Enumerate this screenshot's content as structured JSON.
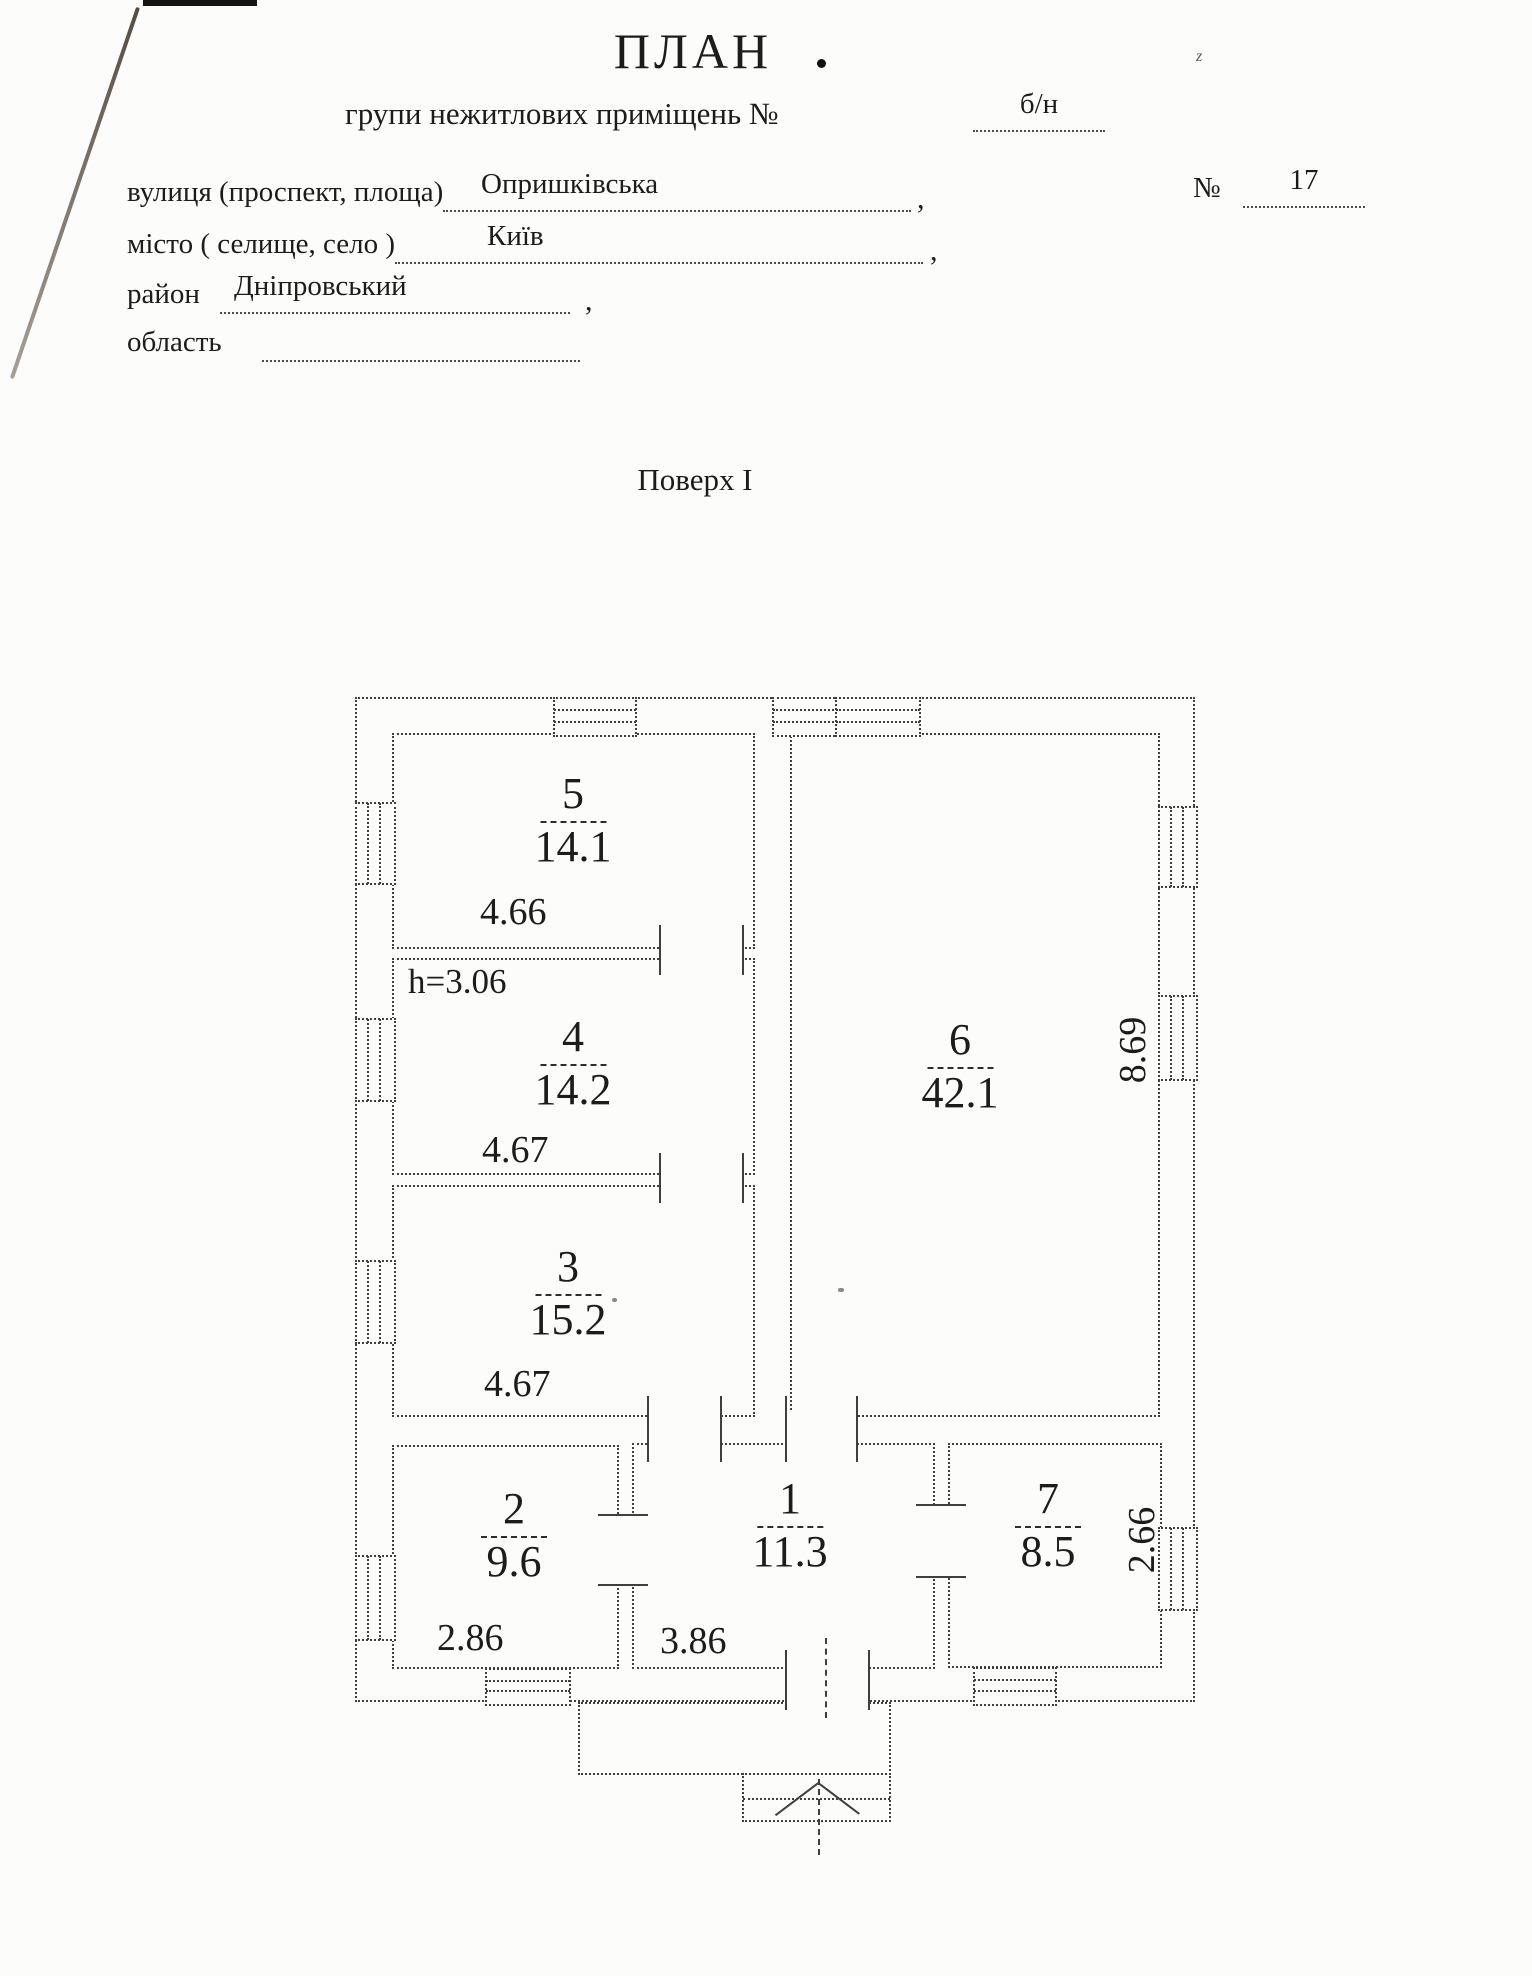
{
  "header": {
    "title": "ПЛАН",
    "subtitle_label": "групи нежитлових приміщень №",
    "subtitle_value": "б/н",
    "street_label": "вулиця (проспект, площа)",
    "street_value": "Опришківська",
    "number_label": "№",
    "number_value": "17",
    "city_label": "місто ( селище, село )",
    "city_value": "Київ",
    "district_label": "район",
    "district_value": "Дніпровський",
    "region_label": "область",
    "region_value": "",
    "comma": ",",
    "floor_title": "Поверх I"
  },
  "plan": {
    "rooms": {
      "r1": {
        "num": "1",
        "area": "11.3",
        "dim": "3.86"
      },
      "r2": {
        "num": "2",
        "area": "9.6",
        "dim": "2.86"
      },
      "r3": {
        "num": "3",
        "area": "15.2",
        "dim": "4.67"
      },
      "r4": {
        "num": "4",
        "area": "14.2",
        "dim": "4.67",
        "height_note": "h=3.06"
      },
      "r5": {
        "num": "5",
        "area": "14.1",
        "dim": "4.66"
      },
      "r6": {
        "num": "6",
        "area": "42.1",
        "dim": "8.69"
      },
      "r7": {
        "num": "7",
        "area": "8.5",
        "dim": "2.66"
      }
    }
  },
  "artifacts": {
    "corner_mark": "z"
  }
}
